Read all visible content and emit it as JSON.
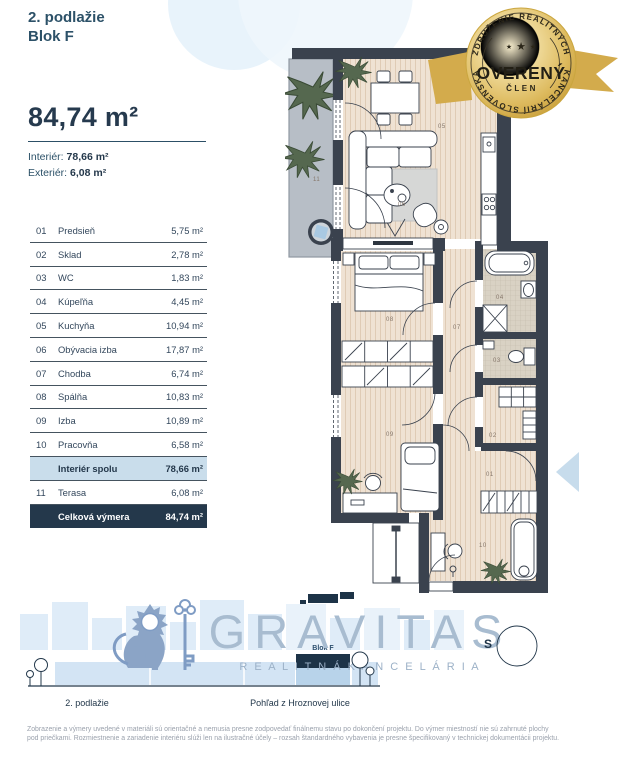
{
  "header": {
    "line1": "2. podlažie",
    "line2": "Blok F"
  },
  "area": {
    "total": "84,74 m²",
    "interior_label": "Interiér:",
    "interior_value": "78,66 m²",
    "exterior_label": "Exteriér:",
    "exterior_value": "6,08 m²"
  },
  "rooms": [
    {
      "num": "01",
      "name": "Predsieň",
      "area": "5,75 m²"
    },
    {
      "num": "02",
      "name": "Sklad",
      "area": "2,78 m²"
    },
    {
      "num": "03",
      "name": "WC",
      "area": "1,83 m²"
    },
    {
      "num": "04",
      "name": "Kúpeľňa",
      "area": "4,45 m²"
    },
    {
      "num": "05",
      "name": "Kuchyňa",
      "area": "10,94 m²"
    },
    {
      "num": "06",
      "name": "Obývacia izba",
      "area": "17,87 m²"
    },
    {
      "num": "07",
      "name": "Chodba",
      "area": "6,74 m²"
    },
    {
      "num": "08",
      "name": "Spálňa",
      "area": "10,83 m²"
    },
    {
      "num": "09",
      "name": "Izba",
      "area": "10,89 m²"
    },
    {
      "num": "10",
      "name": "Pracovňa",
      "area": "6,58 m²"
    }
  ],
  "summary": {
    "interior_label": "Interiér spolu",
    "interior_value": "78,66 m²",
    "terrace_num": "11",
    "terrace_name": "Terasa",
    "terrace_area": "6,08 m²",
    "total_label": "Celková výmera",
    "total_value": "84,74 m²"
  },
  "badge": {
    "arc_top": "ZDRUŽENIE REALITNÝCH",
    "arc_bottom": "KANCELÁRIÍ SLOVENSKA",
    "center": "OVERENÝ",
    "sub": "ČLEN",
    "star": "★"
  },
  "plan": {
    "labels": {
      "r01": "01",
      "r02": "02",
      "r03": "03",
      "r04": "04",
      "r05": "05",
      "r06": "06",
      "r07": "07",
      "r08": "08",
      "r09": "09",
      "r10": "10",
      "r11": "11"
    }
  },
  "logo": {
    "name": "GRAVITAS",
    "tagline": "R E A L I T N Á   K A N C E L Á R I A",
    "block_label": "Blok F",
    "mark": "S"
  },
  "footer": {
    "left_label": "2. podlažie",
    "right_label": "Pohľad z Hroznovej ulice",
    "disclaimer1": "Zobrazenie a výmery uvedené v materiáli sú orientačné a nemusia presne zodpovedať finálnemu stavu po dokončení projektu. Do výmer miestností nie sú zahrnuté plochy",
    "disclaimer2": "pod priečkami. Rozmiestnenie a zariadenie interiéru slúži len na ilustračné účely – rozsah štandardného vybavenia je presne špecifikovaný v technickej dokumentácii projektu."
  },
  "colors": {
    "accent_navy": "#24384b",
    "highlight_blue": "#c9ddeb",
    "badge_gold": "#d3ab4c",
    "wall_dark": "#3a424e",
    "floor_beige": "#efe2d3"
  }
}
